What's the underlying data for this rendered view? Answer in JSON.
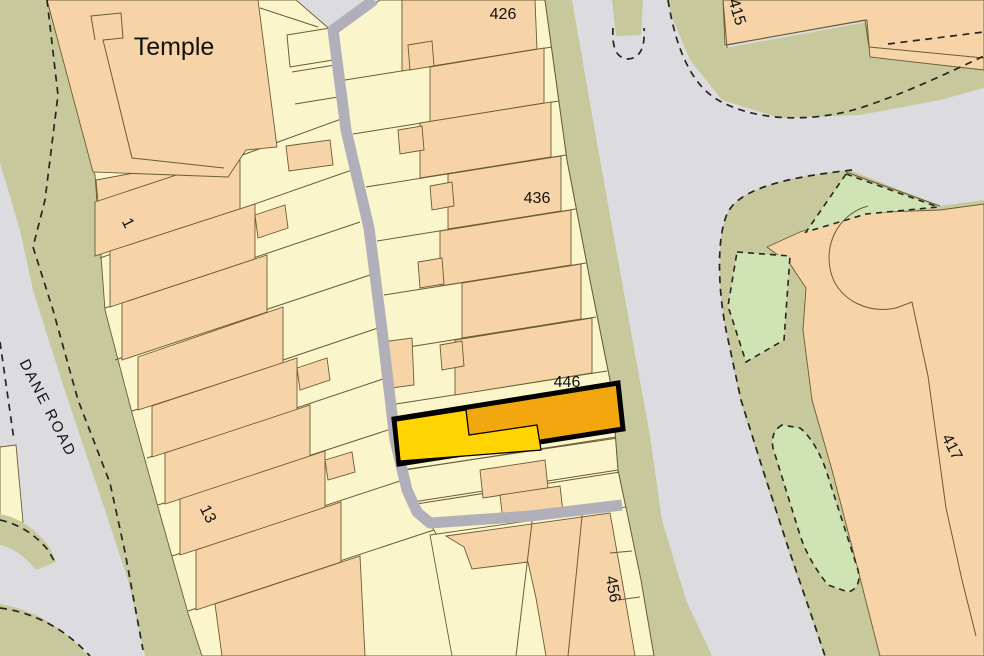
{
  "map": {
    "type": "ordnance-survey-style plot map",
    "highlighted_plot": "446",
    "labels": {
      "temple": "Temple",
      "dane_road": "DANE ROAD",
      "plot_1": "1",
      "plot_13": "13",
      "plot_426": "426",
      "plot_436": "436",
      "plot_446": "446",
      "plot_456": "456",
      "plot_415": "415",
      "plot_417": "417"
    },
    "colors": {
      "road": "#dcdbdf",
      "path": "#b1b0ba",
      "verge": "#c7c89b",
      "green": "#cfe3b4",
      "parcel": "#fbf5cc",
      "building": "#f6d4a7",
      "highlight_fill": "#f2a70f",
      "highlight_yard": "#ffd400",
      "highlight_border": "#000000",
      "boundary": "#6b5c33",
      "dash": "#26261f",
      "label": "#111111"
    }
  }
}
